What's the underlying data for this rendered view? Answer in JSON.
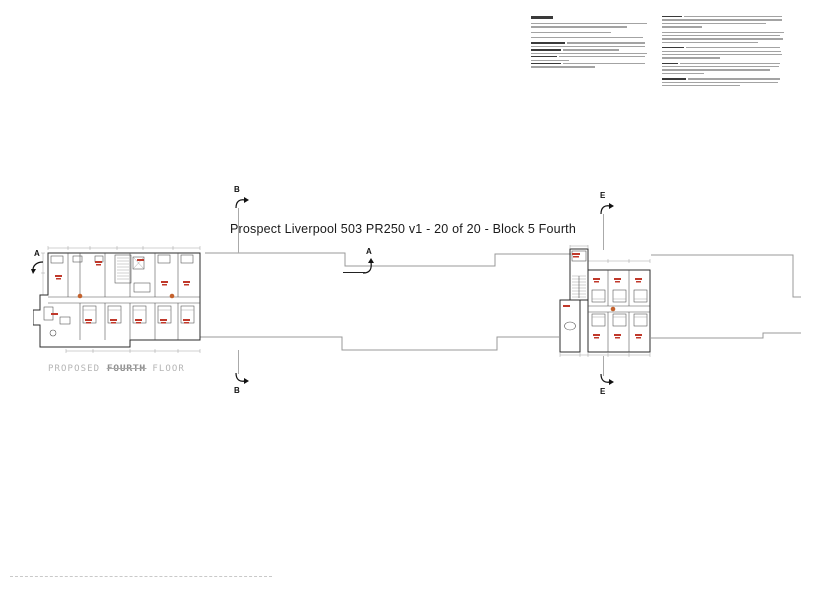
{
  "sheet": {
    "title": "Prospect Liverpool 503 PR250 v1 - 20 of 20 - Block 5 Fourth",
    "floor_label": {
      "pre": "PROPOSED",
      "word": "FOURTH",
      "post": "FLOOR"
    }
  },
  "markers": {
    "a_left": "A",
    "a_mid": "A",
    "b_top": "B",
    "b_bottom": "B",
    "e_top": "E",
    "e_bottom": "E"
  },
  "colors": {
    "red_label": "#c0392b",
    "orange_dot": "#c4622d",
    "plan_line": "#2b2b2b",
    "faint_line": "#9a9a9a",
    "note_text": "#8c8c8c",
    "note_heading": "#3a3a3a",
    "floor_label": "#b5b5b5",
    "title": "#1a1a1a"
  },
  "notes": {
    "left_column": {
      "heading_width": 22,
      "lines": [
        {
          "w": 116
        },
        {
          "w": 96
        },
        {
          "w": 80,
          "gap": 1
        },
        {
          "w": 112,
          "gap": 1
        },
        {
          "lead": 34,
          "w": 78,
          "gap": 1
        },
        {
          "w": 114
        },
        {
          "lead": 30,
          "w": 56
        },
        {
          "w": 116
        },
        {
          "lead": 26,
          "w": 86
        },
        {
          "w": 38
        },
        {
          "lead": 30,
          "w": 82
        },
        {
          "w": 64
        }
      ]
    },
    "right_column": {
      "lines": [
        {
          "lead": 20,
          "w": 98
        },
        {
          "w": 120
        },
        {
          "w": 104
        },
        {
          "w": 40
        },
        {
          "w": 122,
          "gap": 1
        },
        {
          "w": 118
        },
        {
          "w": 121
        },
        {
          "w": 96
        },
        {
          "lead": 22,
          "w": 94,
          "gap": 1
        },
        {
          "w": 119
        },
        {
          "w": 120
        },
        {
          "w": 58
        },
        {
          "lead": 16,
          "w": 100,
          "gap": 1
        },
        {
          "w": 117
        },
        {
          "w": 108
        },
        {
          "w": 42
        },
        {
          "lead": 24,
          "w": 92,
          "gap": 1
        },
        {
          "w": 116
        },
        {
          "w": 78
        }
      ]
    }
  }
}
